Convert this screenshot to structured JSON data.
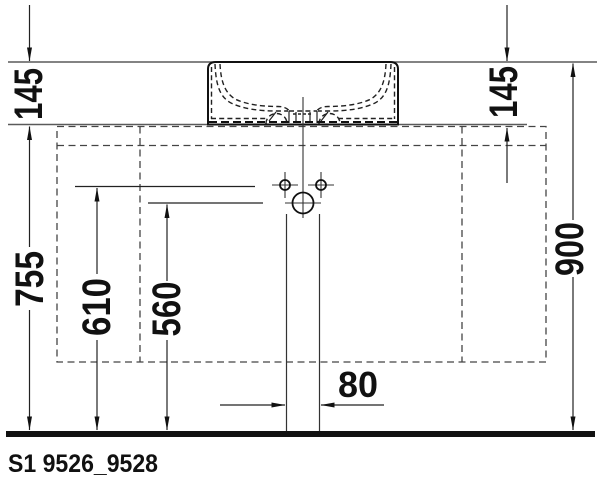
{
  "title": "Washbasin installation technical drawing",
  "colors": {
    "ink": "#111111",
    "thin_line": "#555555",
    "background": "#ffffff"
  },
  "labels": {
    "product_code": "S1 9526_9528"
  },
  "dimensions_mm": {
    "basin_height_left": "145",
    "basin_height_right": "145",
    "floor_to_counter": "755",
    "floor_to_faucet_holes": "610",
    "floor_to_drain": "560",
    "floor_to_rim": "900",
    "drain_pipe_width": "80"
  }
}
